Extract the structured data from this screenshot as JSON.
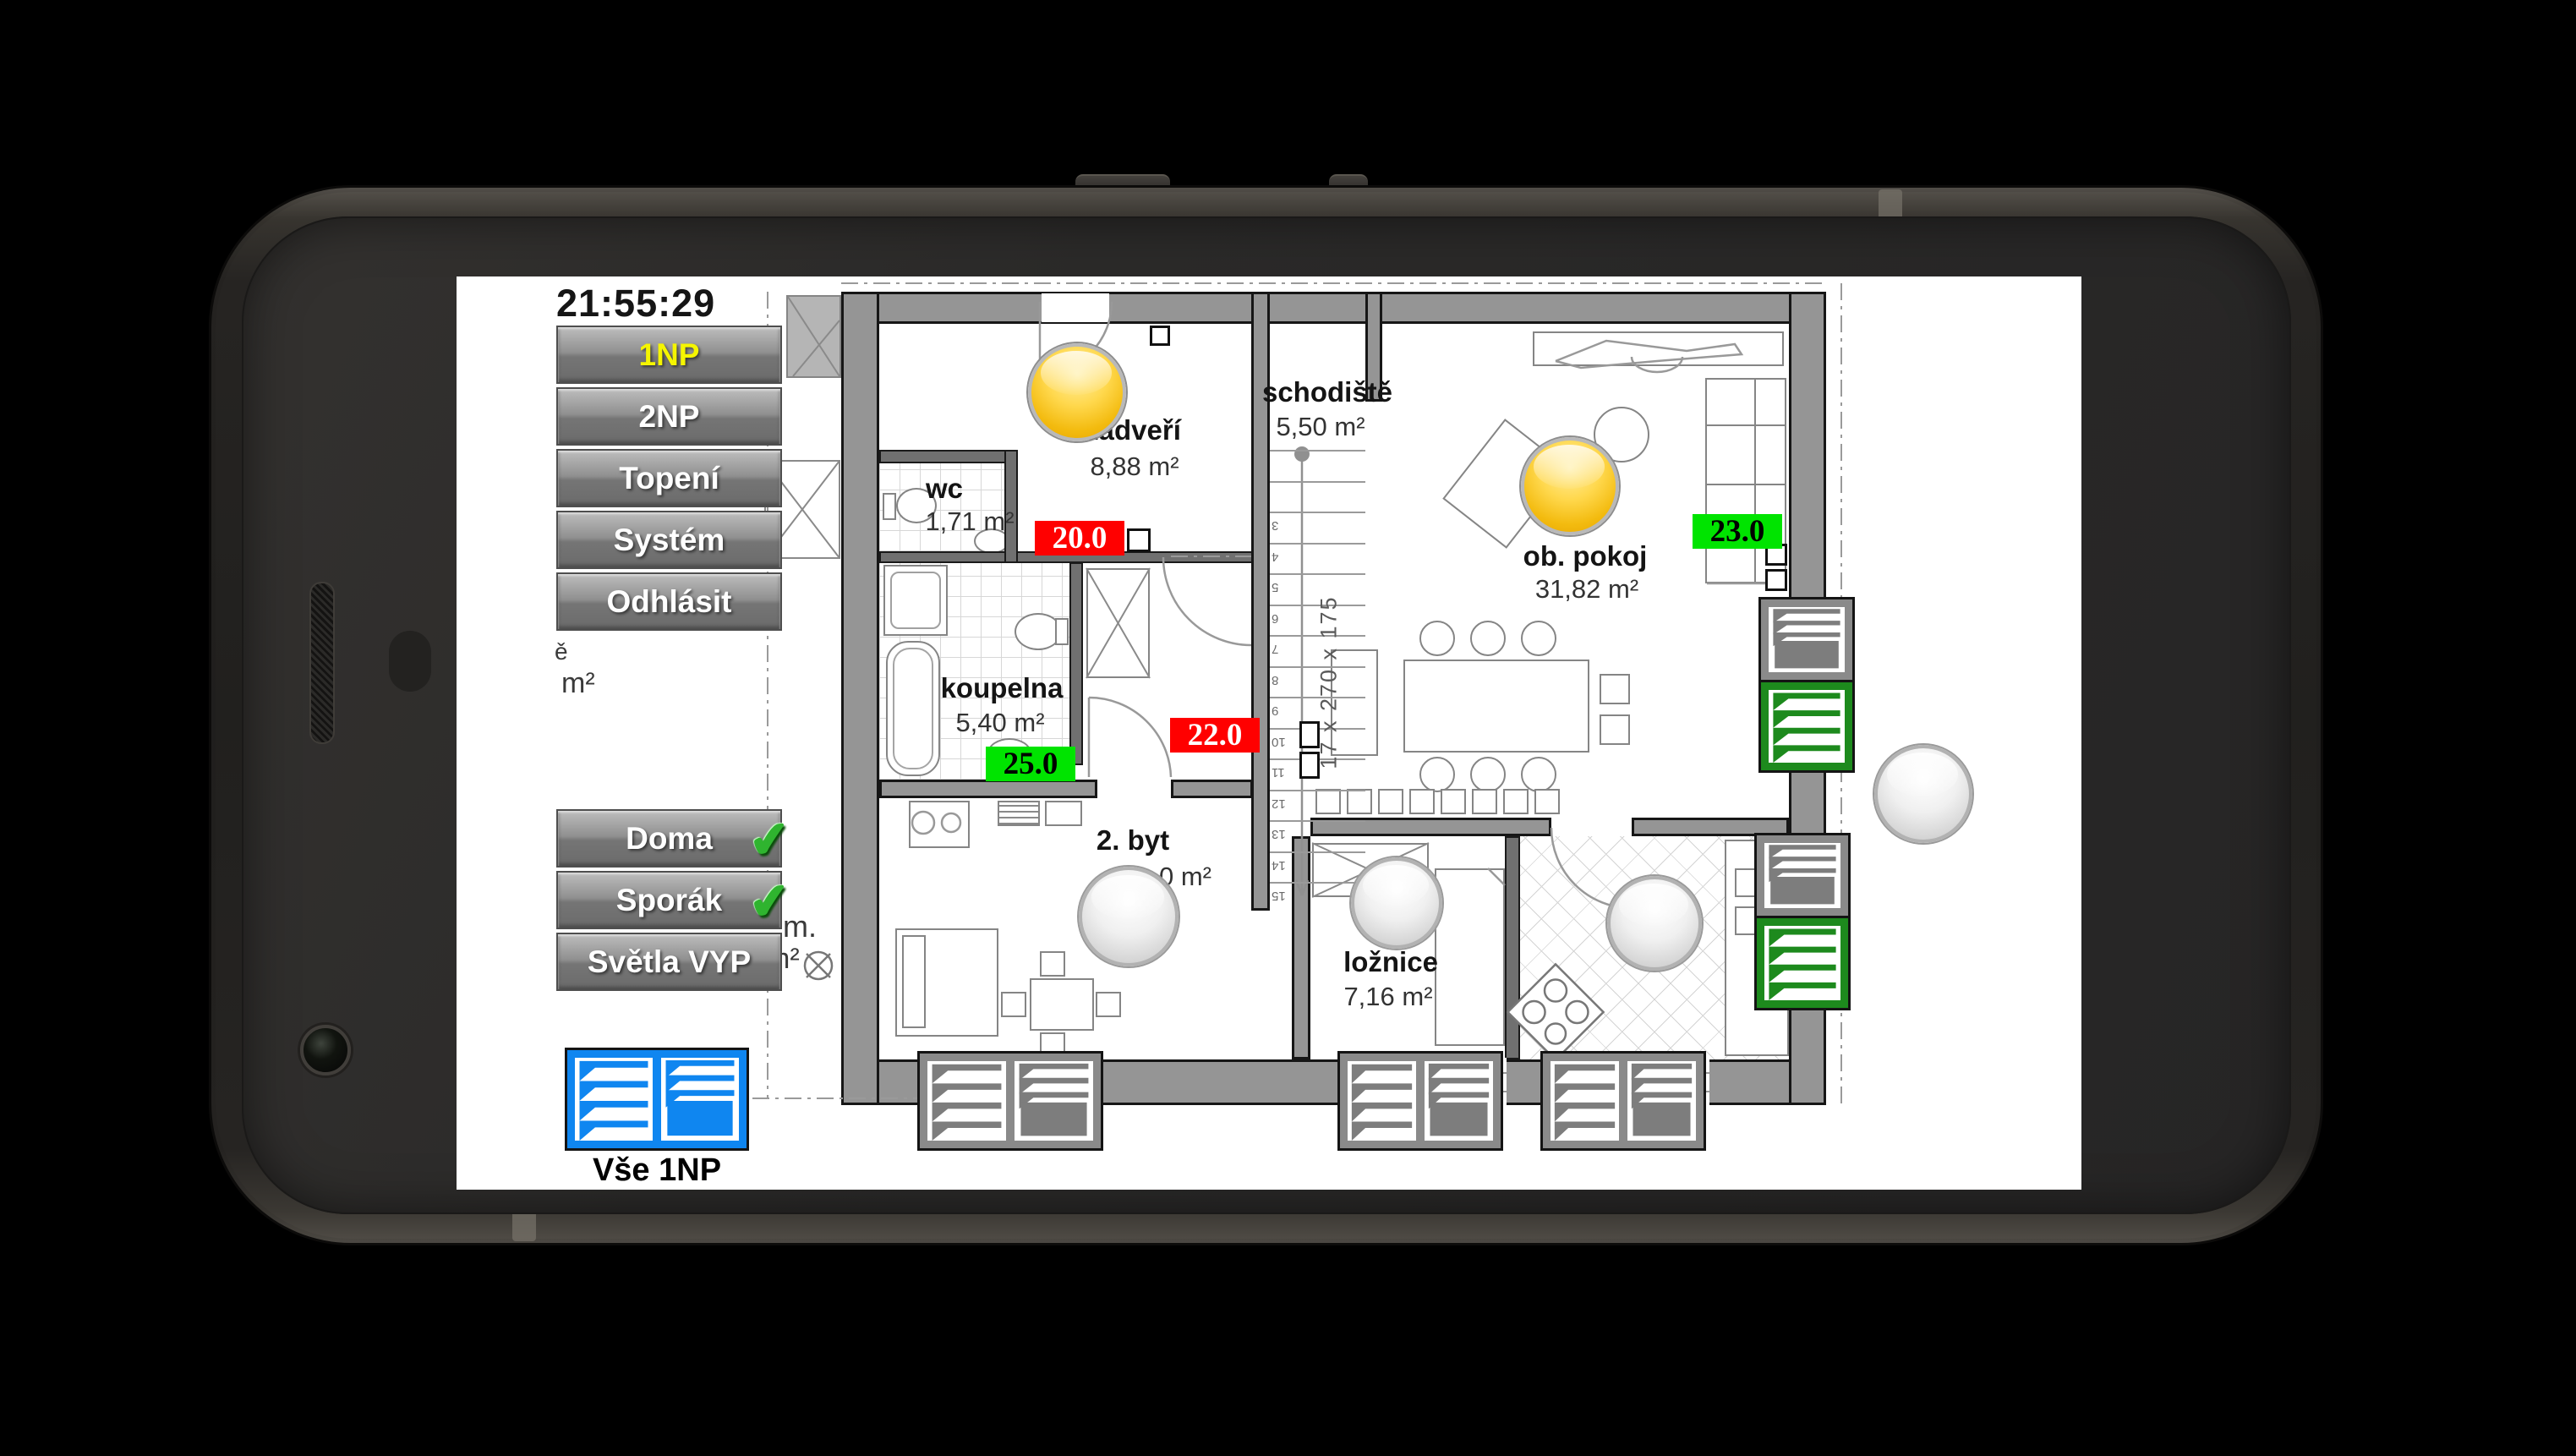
{
  "device": {
    "time": "21:55:29"
  },
  "nav": {
    "items": [
      {
        "label": "1NP",
        "active": true
      },
      {
        "label": "2NP",
        "active": false
      },
      {
        "label": "Topení",
        "active": false
      },
      {
        "label": "Systém",
        "active": false
      },
      {
        "label": "Odhlásit",
        "active": false
      }
    ]
  },
  "quick_actions": {
    "check_icon": "✔",
    "items": [
      {
        "label": "Doma",
        "checked": true
      },
      {
        "label": "Sporák",
        "checked": true
      },
      {
        "label": "Světla VYP",
        "checked": false
      }
    ]
  },
  "all_blinds": {
    "label": "Vše 1NP"
  },
  "floorplan": {
    "rooms": {
      "zadveri": {
        "name": "zádveří",
        "area": "8,88 m²"
      },
      "wc": {
        "name": "wc",
        "area": "1,71 m²"
      },
      "koupelna": {
        "name": "koupelna",
        "area": "5,40 m²"
      },
      "schodiste": {
        "name": "schodiště",
        "area": "5,50 m²"
      },
      "ob_pokoj": {
        "name": "ob. pokoj",
        "area": "31,82 m²"
      },
      "byt2": {
        "name": "2. byt",
        "area_visible": "0 m²"
      },
      "loznice": {
        "name": "ložnice",
        "area": "7,16 m²"
      }
    },
    "temperatures": {
      "wc": {
        "value": "20.0",
        "state": "red"
      },
      "chodba": {
        "value": "22.0",
        "state": "red"
      },
      "koupelna": {
        "value": "25.0",
        "state": "green"
      },
      "ob_pokoj": {
        "value": "23.0",
        "state": "green"
      }
    },
    "stairs": {
      "dimension": "17 x 270 x 175",
      "step_numbers": [
        3,
        4,
        5,
        6,
        7,
        8,
        9,
        10,
        11,
        12,
        13,
        14,
        15
      ]
    },
    "lights": {
      "zadveri": "on",
      "ob_pokoj": "on",
      "byt2": "off",
      "loznice": "off",
      "kuchyn": "off",
      "terasa": "off"
    },
    "blinds": {
      "living_window": [
        "closed-gray",
        "open-green"
      ],
      "kitchen_window": [
        "closed-gray",
        "open-green"
      ],
      "byt2_window": [
        "open-gray",
        "closed-gray"
      ],
      "loznice_window": [
        "open-gray",
        "closed-gray"
      ],
      "kuchyn_window": [
        "open-gray",
        "closed-gray"
      ],
      "vse_1np": [
        "open-blue",
        "closed-blue"
      ]
    },
    "fragments": {
      "left_letter": "ě",
      "left_area": "m²",
      "mid_dot": "m.",
      "mid_area": "m²"
    }
  },
  "colors": {
    "temp_red": "#ff0000",
    "temp_green": "#00e400",
    "blind_green": "#1d8a1d",
    "blind_blue": "#0f86f0",
    "nav_active_text": "#f5f500",
    "bulb_on": "#f5bb10"
  }
}
